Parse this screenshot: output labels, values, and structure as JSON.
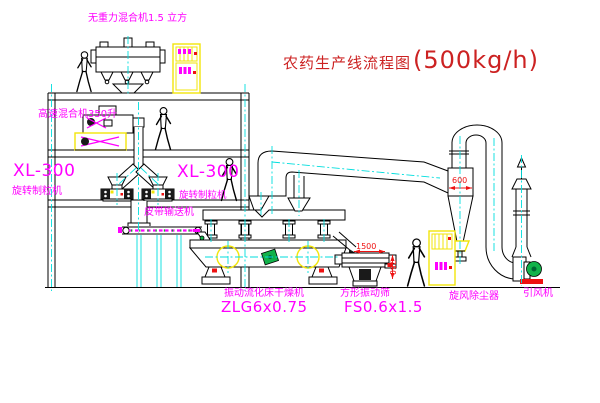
{
  "title": {
    "name": "农药生产线流程图",
    "capacity": "(500kg/h)"
  },
  "labels": {
    "gravity_mixer": "无重力混合机1.5 立方",
    "high_speed_mixer": "高速混合机350升",
    "granulator_left_model": "XL-300",
    "granulator_left_name": "旋转制粒机",
    "granulator_right_model": "XL-300",
    "granulator_right_name": "旋转制粒机",
    "belt_conveyor": "皮带输送机",
    "dryer_name": "振动流化床干燥机",
    "dryer_model": "ZLG6x0.75",
    "sieve_name": "方形振动筛",
    "sieve_model": "FS0.6x1.5",
    "cyclone": "旋风除尘器",
    "fan": "引风机"
  },
  "dimensions": {
    "cyclone_width": "600",
    "sieve_length": "1500",
    "sieve_height": "750"
  },
  "colors": {
    "line": "#000000",
    "centerline": "#00dede",
    "label": "#ff00ff",
    "title": "#cc2222",
    "dimension": "#ee1111",
    "highlight": "#f2e50a",
    "motor_green": "#12b24a"
  }
}
